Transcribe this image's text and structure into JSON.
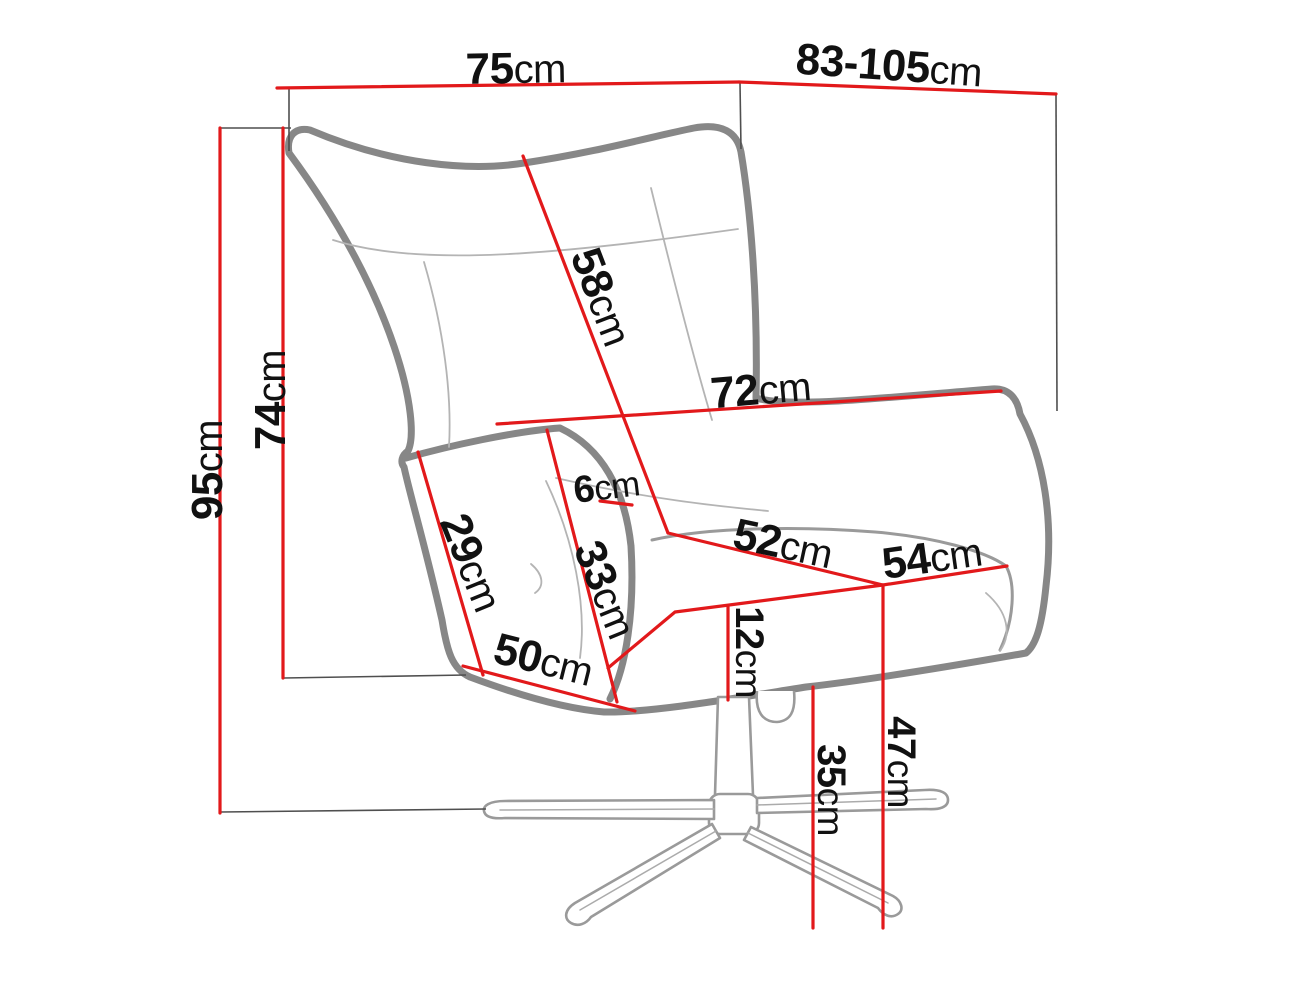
{
  "page": {
    "background": "#ffffff"
  },
  "unit_suffix": "cm",
  "colors": {
    "dimension_line": "#e2191b",
    "chair_outline": "#878787",
    "seam_line": "#b4b4b4",
    "extension_line": "#4f4f4f",
    "base_metal": "#9a9a9a",
    "label_text": "#111111"
  },
  "measurements": [
    {
      "id": "top-width",
      "value": "75",
      "unit": "cm"
    },
    {
      "id": "top-depth-range",
      "value": "83-105",
      "unit": "cm"
    },
    {
      "id": "overall-height",
      "value": "95",
      "unit": "cm"
    },
    {
      "id": "back-height",
      "value": "74",
      "unit": "cm"
    },
    {
      "id": "backrest-diagonal",
      "value": "58",
      "unit": "cm"
    },
    {
      "id": "inner-back-width",
      "value": "72",
      "unit": "cm"
    },
    {
      "id": "armrest-thickness",
      "value": "6",
      "unit": "cm"
    },
    {
      "id": "armrest-outer-length",
      "value": "29",
      "unit": "cm"
    },
    {
      "id": "armrest-inner-length",
      "value": "33",
      "unit": "cm"
    },
    {
      "id": "seat-width",
      "value": "52",
      "unit": "cm"
    },
    {
      "id": "seat-depth",
      "value": "54",
      "unit": "cm"
    },
    {
      "id": "cushion-thickness",
      "value": "12",
      "unit": "cm"
    },
    {
      "id": "front-base-width",
      "value": "50",
      "unit": "cm"
    },
    {
      "id": "seat-height",
      "value": "47",
      "unit": "cm"
    },
    {
      "id": "base-clearance",
      "value": "35",
      "unit": "cm"
    }
  ]
}
